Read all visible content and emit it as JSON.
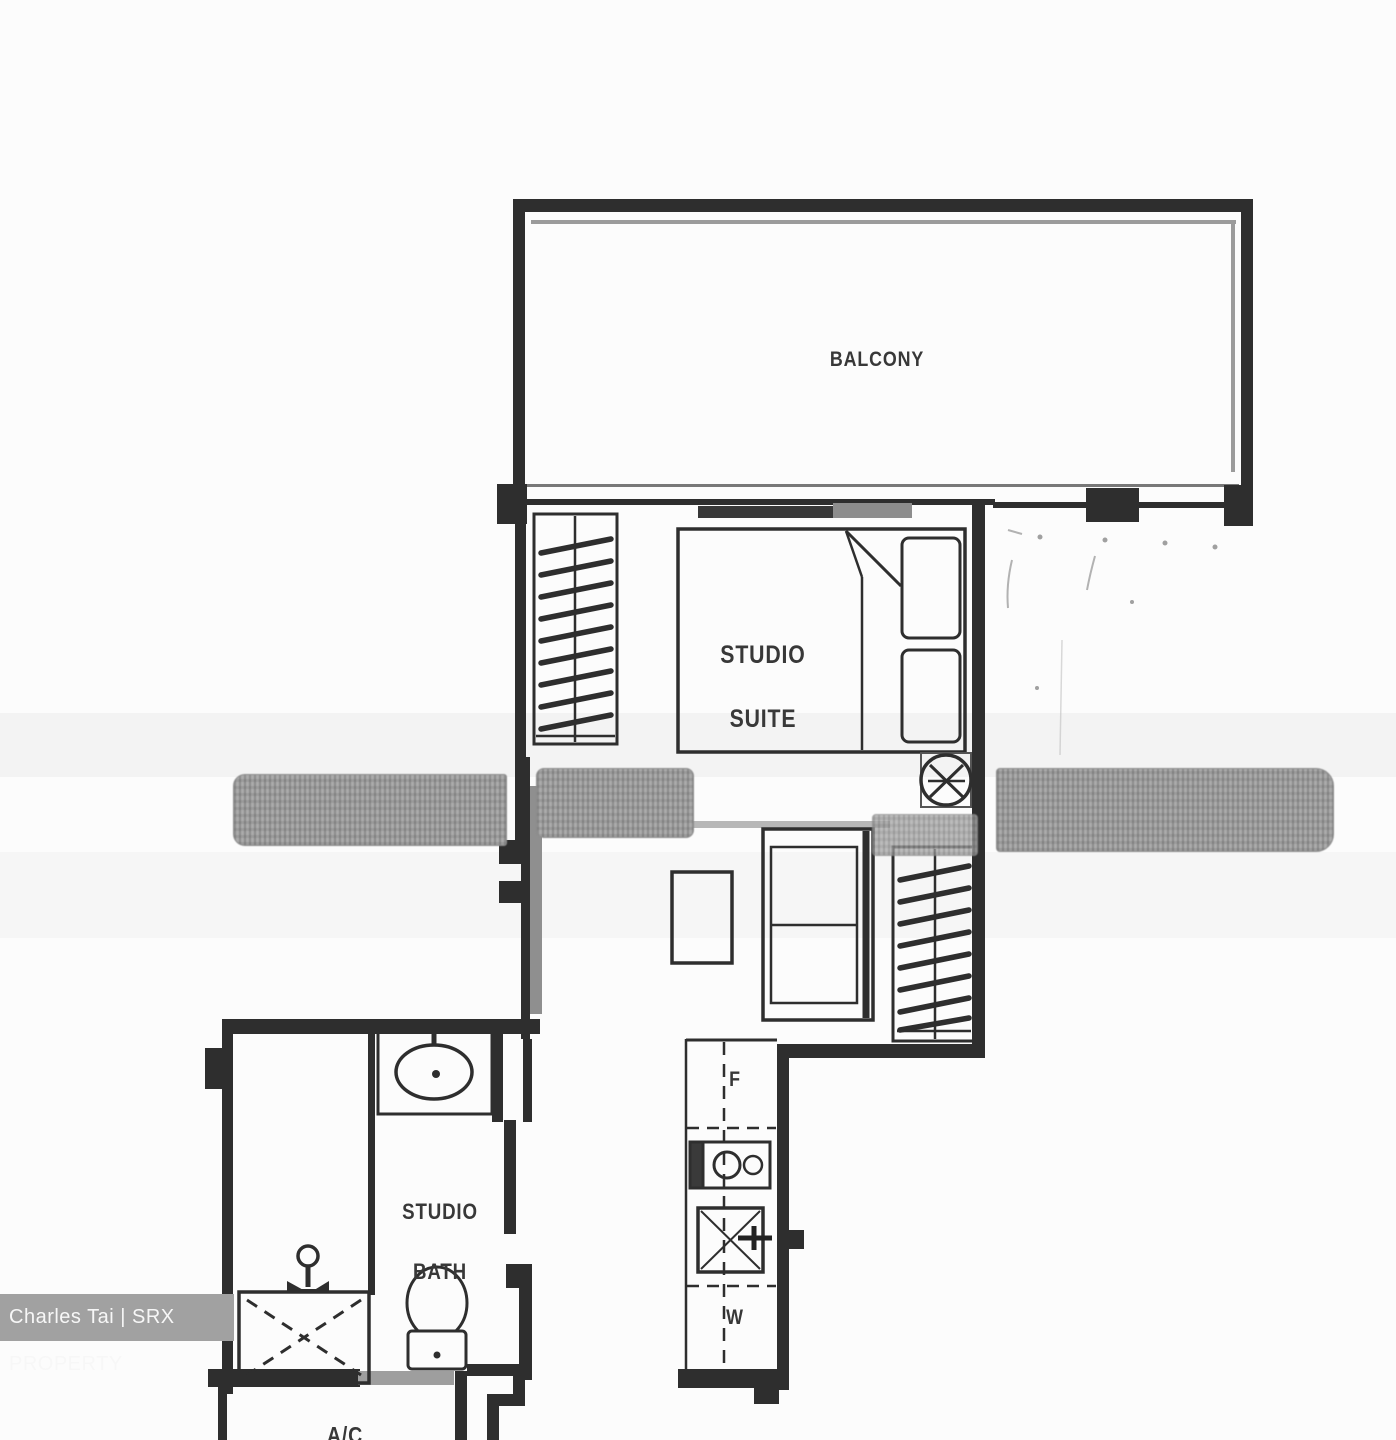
{
  "labels": {
    "balcony": "BALCONY",
    "suite_line1": "STUDIO",
    "suite_line2": "SUITE",
    "bath_line1": "STUDIO",
    "bath_line2": "BATH",
    "fridge": "F",
    "washer": "W",
    "ac": "A/C"
  },
  "watermark": {
    "text": "Charles Tai | SRX PROPERTY"
  },
  "fixtures": [
    "wardrobe-icon",
    "hanger-rail-icon",
    "bed-icon",
    "pillow-icon",
    "blanket-fold-icon",
    "side-table-icon",
    "sofa-icon",
    "coffee-table-icon",
    "sliding-door-icon",
    "entry-door-icon",
    "stove-icon",
    "kitchen-sink-icon",
    "vanity-basin-icon",
    "shower-head-icon",
    "shower-tray-icon",
    "toilet-icon",
    "smudge-redaction-band"
  ],
  "colors": {
    "wall": "#2e2e2e",
    "background": "#fcfcfc",
    "smudge": "#ababab",
    "grey_line": "#9b9b9b",
    "watermark_bg": "#a1a1a1",
    "watermark_text": "#f7f7f7"
  }
}
